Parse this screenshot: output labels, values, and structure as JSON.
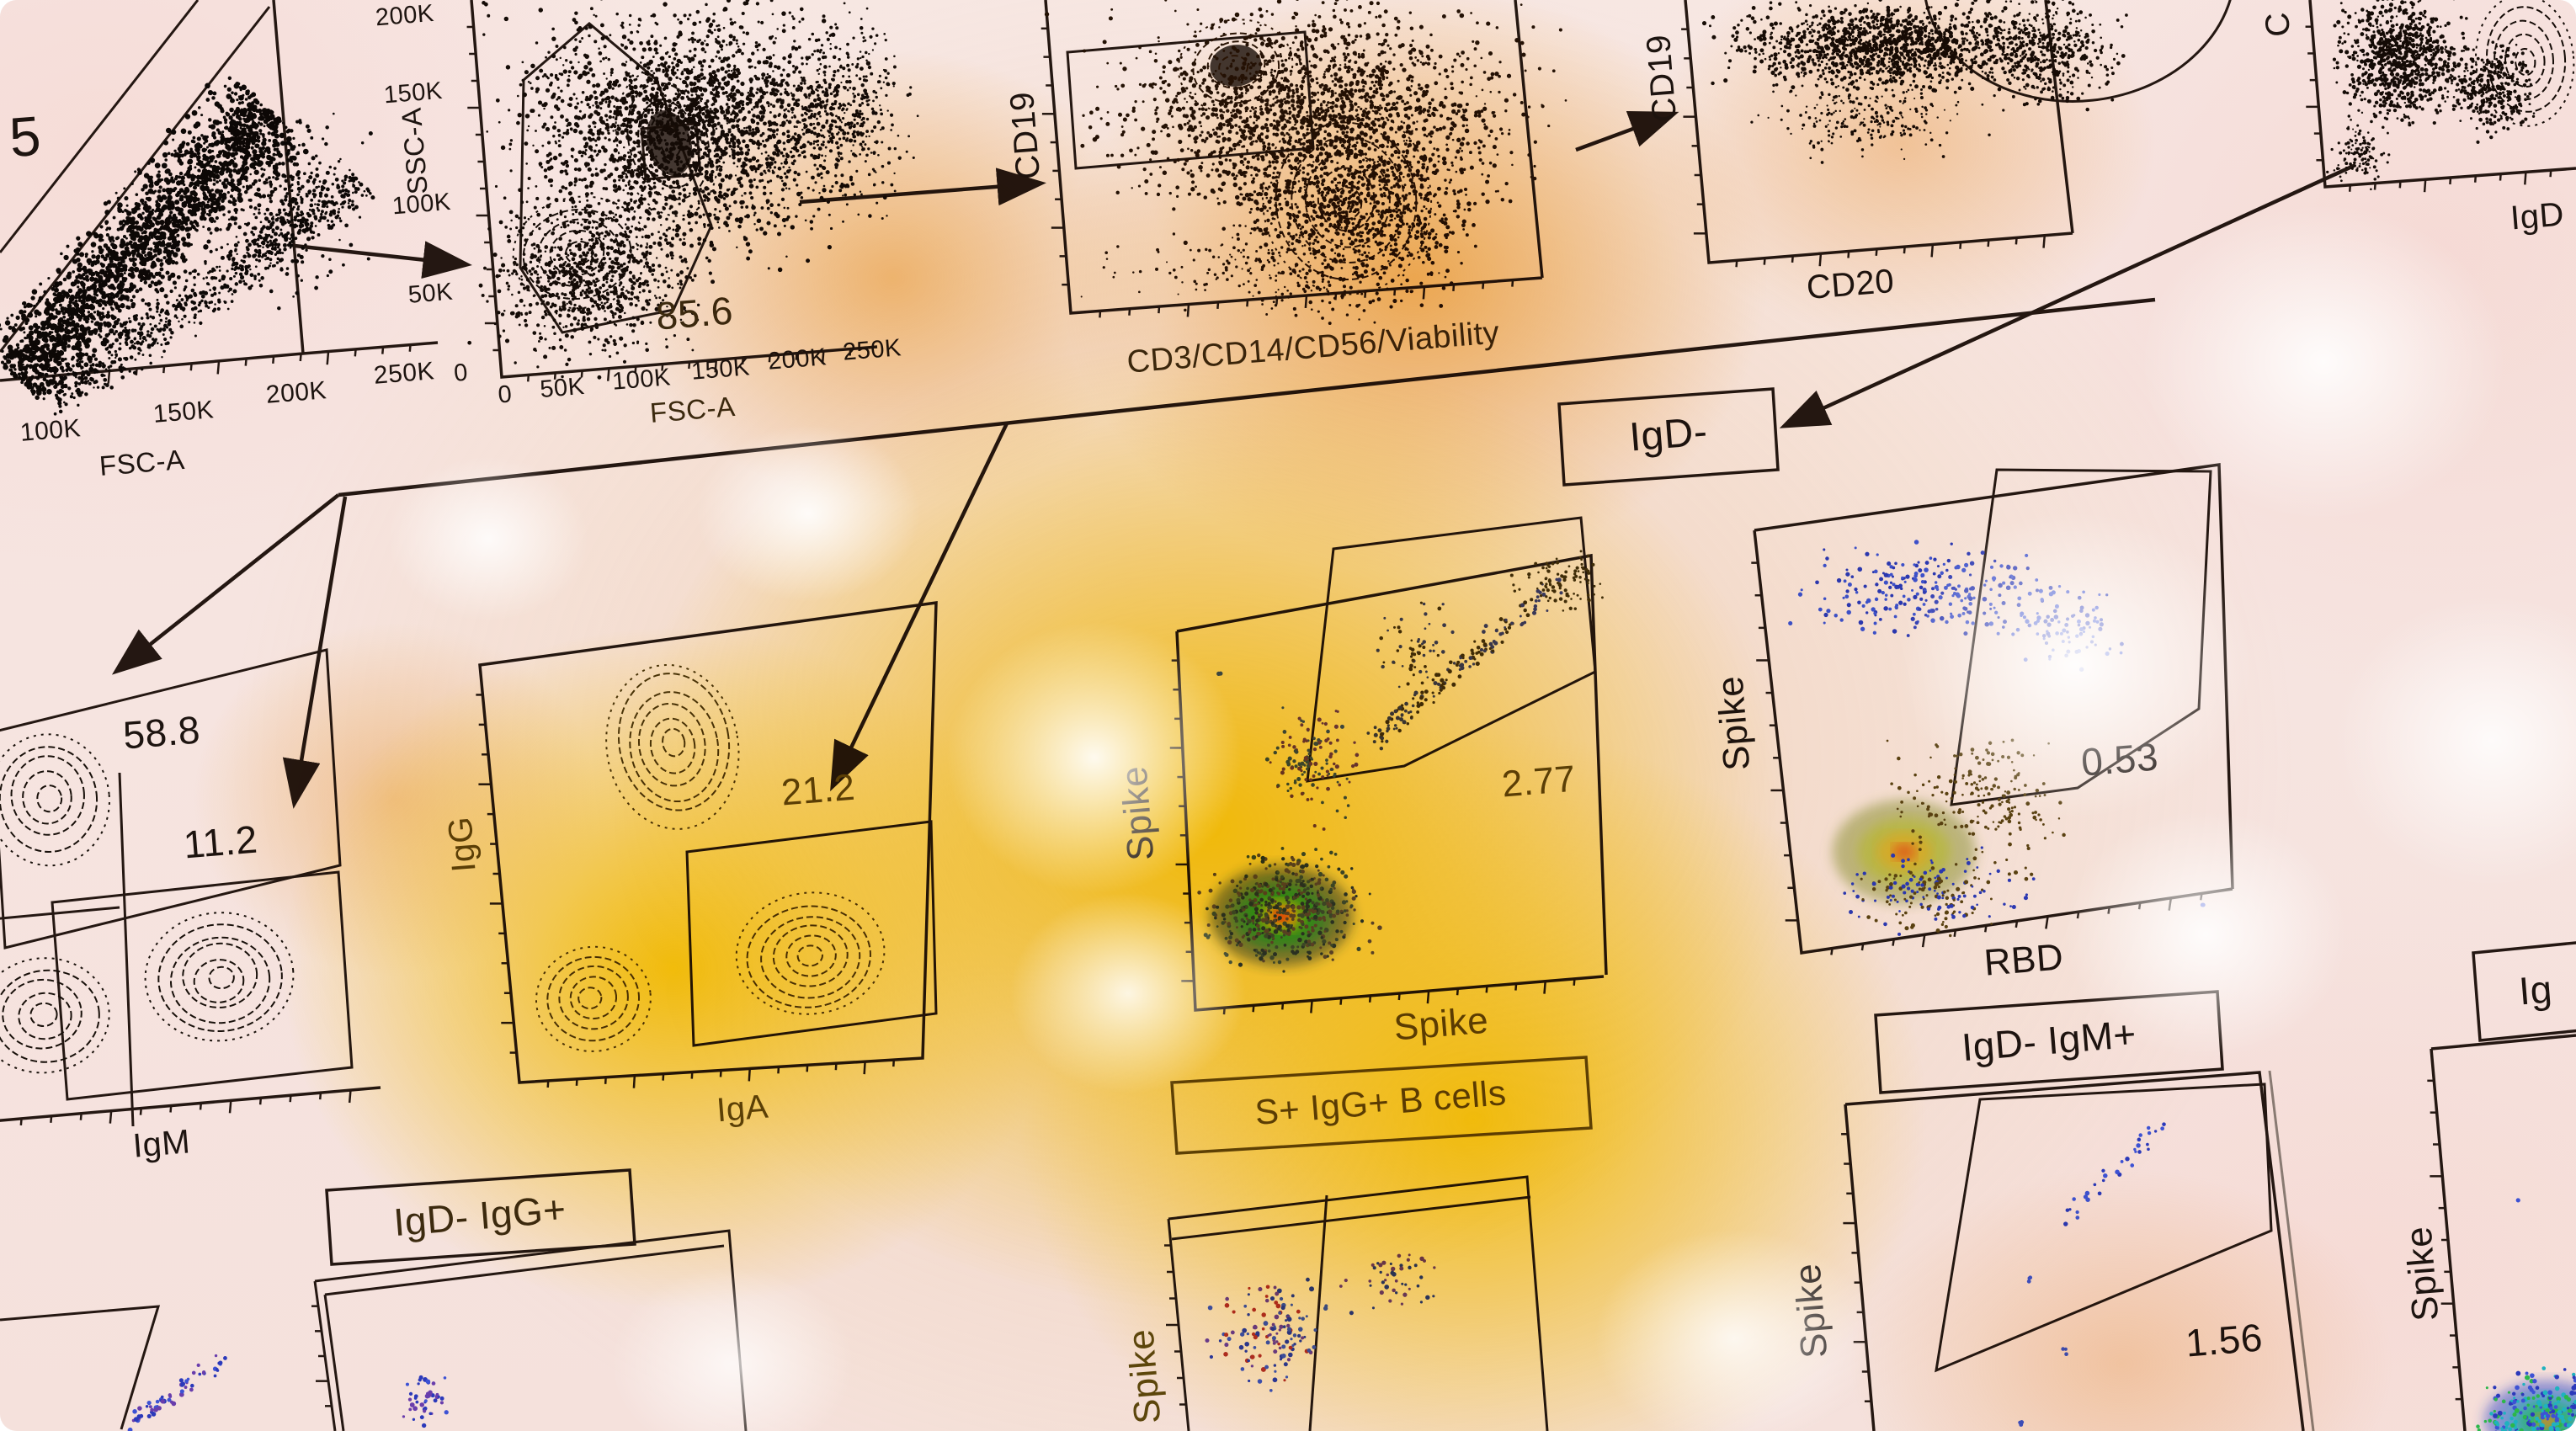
{
  "chart_data": {
    "type": "scatter",
    "description": "Flow cytometry sequential gating strategy figure: contour and pseudocolor dot plots with polygon gates, gate percentages and connecting arrows, overlaid by a yellow stain wash",
    "gate_percentages": [
      5,
      85.6,
      58.8,
      11.2,
      21.2,
      2.77,
      0.53,
      1.56
    ],
    "panels": {
      "p1": {
        "xlabel": "FSC-A",
        "xticks": [
          "100K",
          "150K",
          "200K",
          "250K"
        ],
        "percent": "5",
        "note": "diagonal singlet gate, dense black scatter band"
      },
      "p2": {
        "xlabel": "FSC-A",
        "ylabel": "SSC-A",
        "xticks": [
          "0",
          "50K",
          "100K",
          "150K",
          "200K",
          "250K"
        ],
        "yticks": [
          "200K",
          "150K",
          "100K",
          "50K",
          "0"
        ],
        "percent": "85.6",
        "note": "lymphocyte polygon gate on contour plot"
      },
      "p3": {
        "xlabel": "CD3/CD14/CD56/Viability",
        "ylabel": "CD19",
        "note": "rectangle gate on CD19+ dump-negative cells"
      },
      "p4": {
        "xlabel": "CD20",
        "ylabel": "CD19",
        "note": "large ellipse gate, top cut off"
      },
      "p5": {
        "xlabel": "IgD",
        "ylabel": "C",
        "note": "top-right plot, labels cut off at image edge"
      },
      "p6": {
        "xlabel": "IgM",
        "percents": [
          "58.8",
          "11.2"
        ],
        "note": "quadrant-style contour plot with two rectangle gates"
      },
      "p7": {
        "xlabel": "IgA",
        "ylabel": "IgG",
        "percent": "21.2",
        "note": "rectangle gate on IgA+ population"
      },
      "p8": {
        "xlabel": "Spike",
        "ylabel": "Spike",
        "percent": "2.77",
        "note": "pseudocolor heat blob bottom-left, diagonal double-positive gate"
      },
      "p9": {
        "xlabel": "RBD",
        "ylabel": "Spike",
        "percent": "0.53",
        "note": "polygon gate upper right, heat blob bottom-left"
      },
      "p12": {
        "ylabel": "Spike",
        "note": "bottom-middle partial plot with vertical gate divider"
      },
      "pd": {
        "ylabel": "Spike",
        "percent": "1.56",
        "note": "bottom-right trapezoid gate plot"
      },
      "pe": {
        "ylabel": "Spike",
        "note": "far-right bottom partial plot with rainbow population"
      }
    },
    "boxes": {
      "igd_minus": "IgD-",
      "igd_igg": "IgD- IgG+",
      "s_igg_bcells": "S+ IgG+ B cells",
      "igd_igm": "IgD- IgM+",
      "ig_partial": "Ig"
    }
  }
}
